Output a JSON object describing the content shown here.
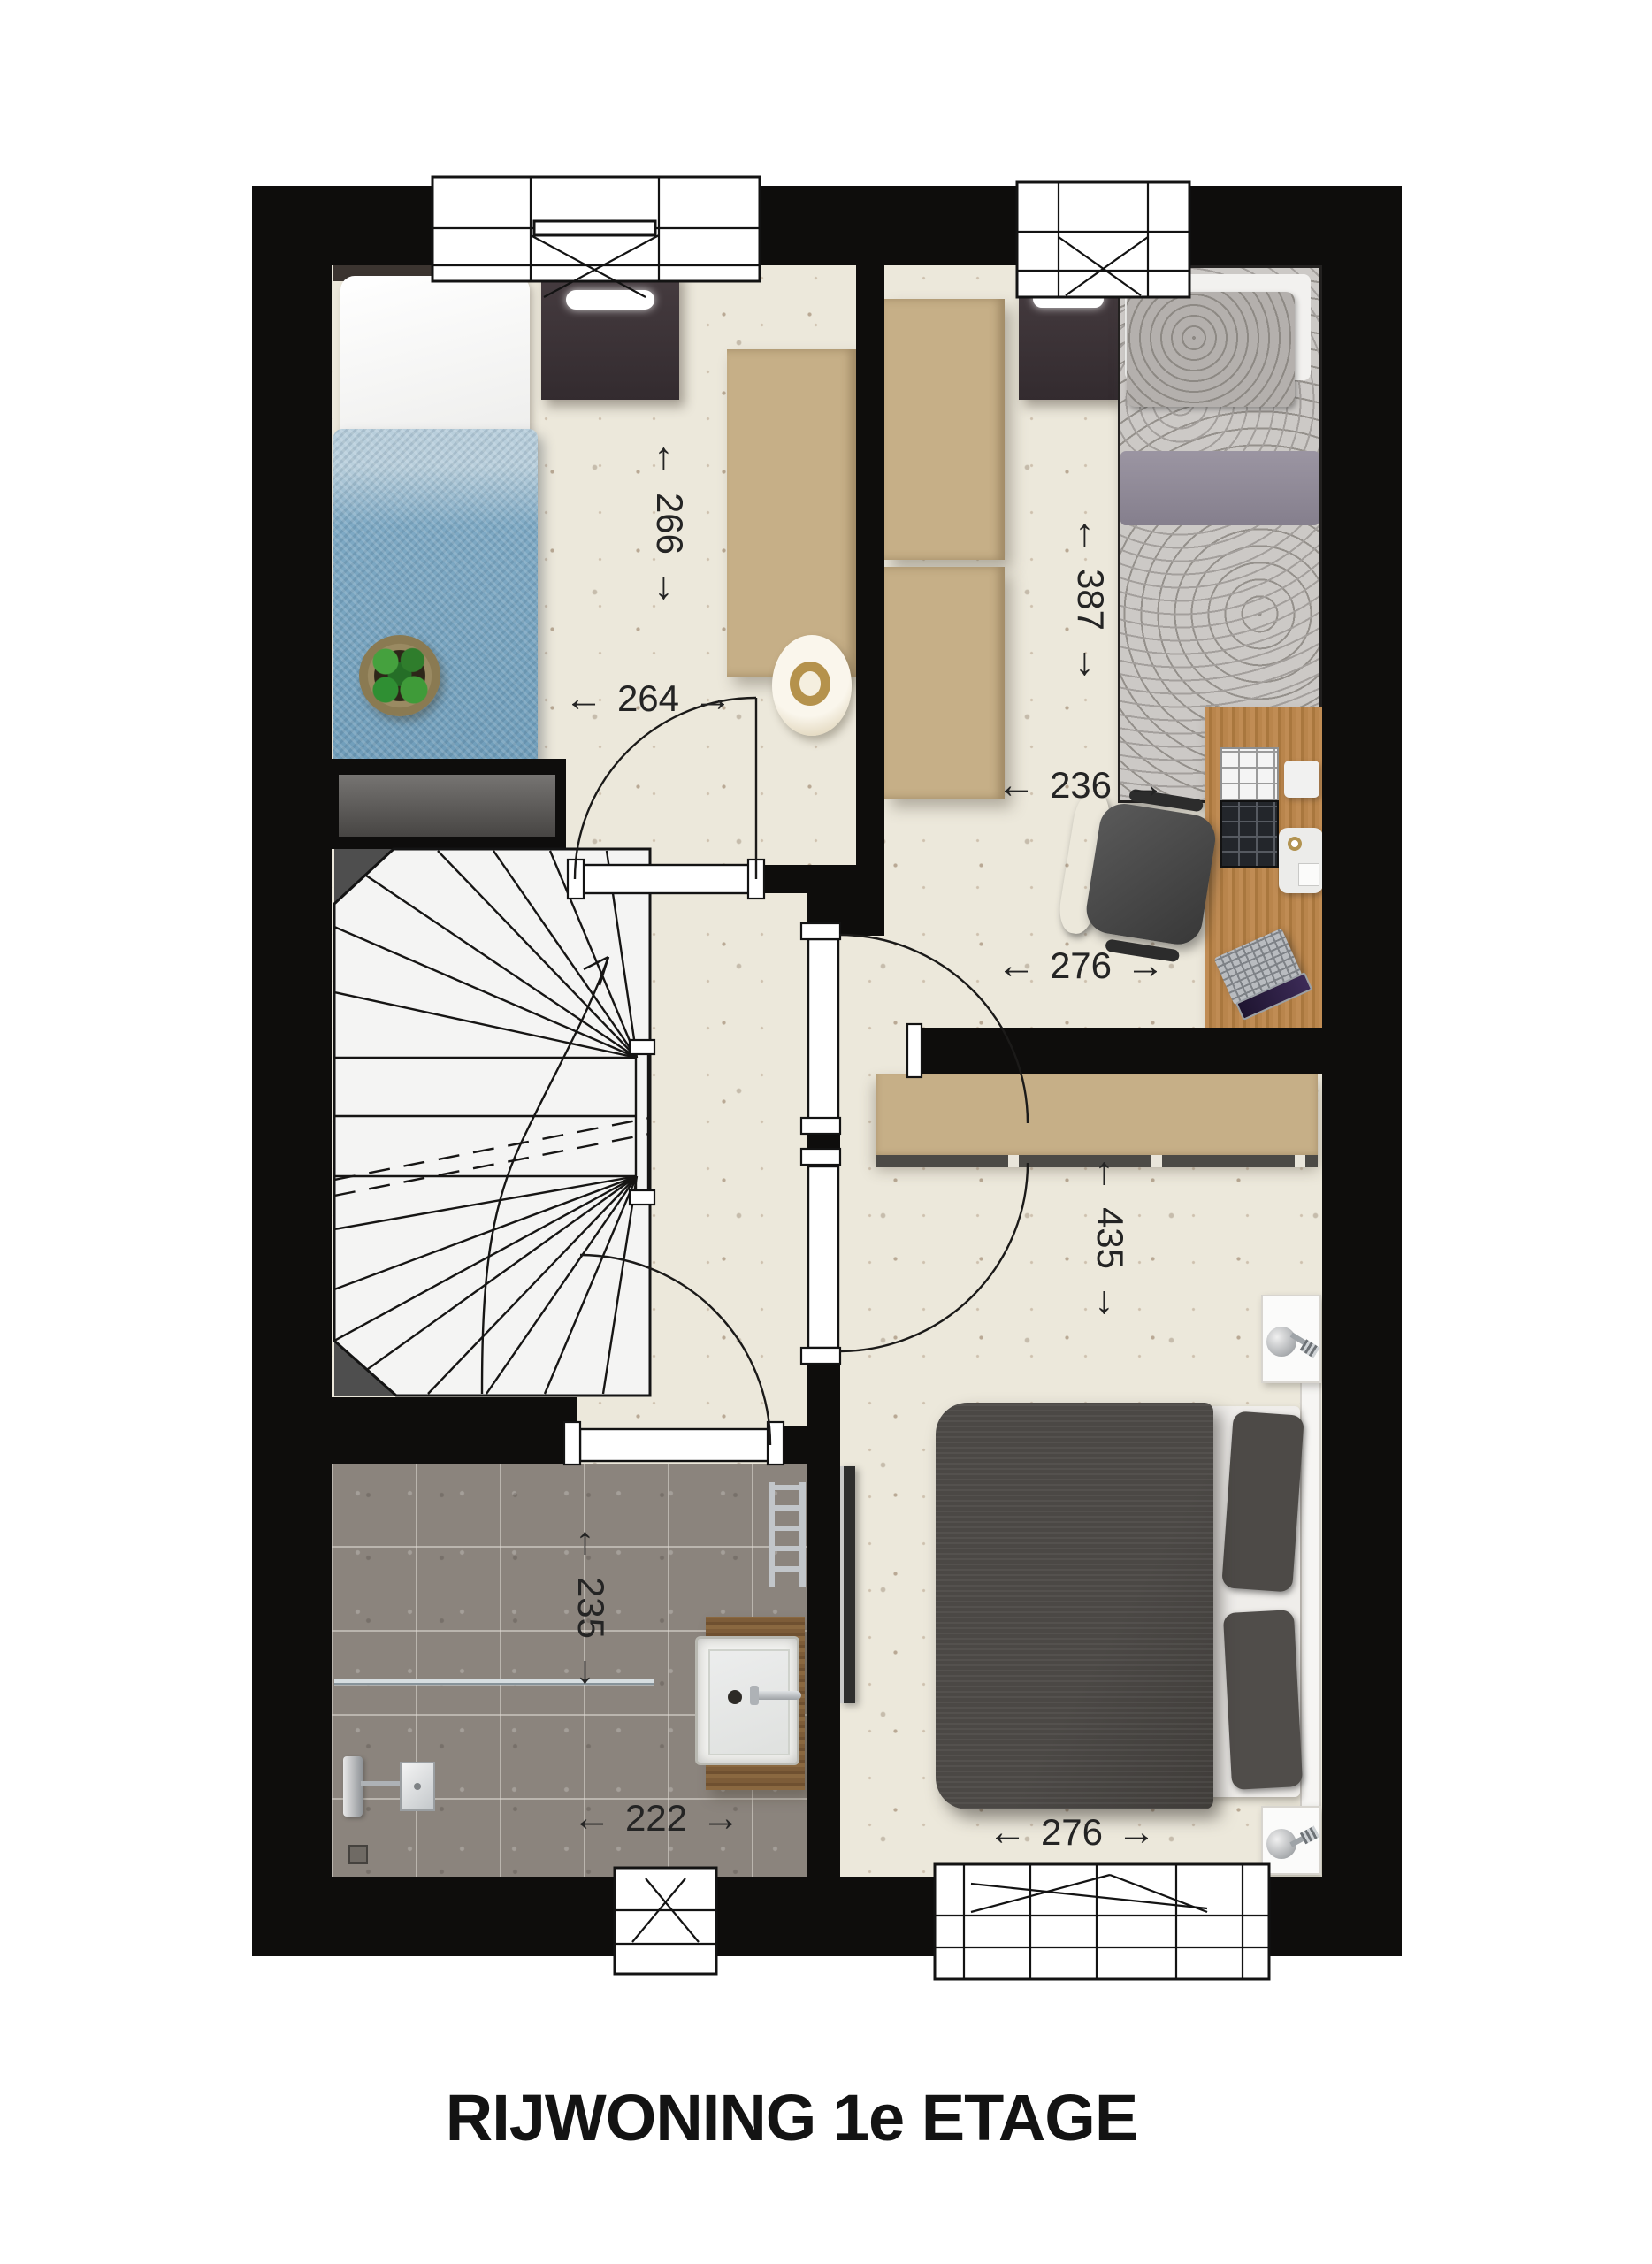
{
  "title": "RIJWONING 1e ETAGE",
  "icons": {
    "arrow_left": "←",
    "arrow_right": "→"
  },
  "dimensions": {
    "bedroom1_depth": {
      "value": "266",
      "orientation": "vertical"
    },
    "bedroom1_width": {
      "value": "264",
      "orientation": "horizontal"
    },
    "bedroom2_depth": {
      "value": "387",
      "orientation": "vertical"
    },
    "bedroom2_width_upper": {
      "value": "236",
      "orientation": "horizontal"
    },
    "bedroom2_width_lower": {
      "value": "276",
      "orientation": "horizontal"
    },
    "bedroom3_depth": {
      "value": "435",
      "orientation": "vertical"
    },
    "bedroom3_width": {
      "value": "276",
      "orientation": "horizontal"
    },
    "bathroom_depth": {
      "value": "235",
      "orientation": "vertical"
    },
    "bathroom_width": {
      "value": "222",
      "orientation": "horizontal"
    }
  },
  "colors": {
    "wall": "#0e0d0c",
    "floor": "#ece8db",
    "bathroom_tile": "#8b847d",
    "wardrobe": "#c6af87",
    "desk_wood": "#b9854c",
    "duvet_blue": "#7ea9c4",
    "duvet_dark": "#474441",
    "bedding_gray": "#ccc9c6"
  }
}
